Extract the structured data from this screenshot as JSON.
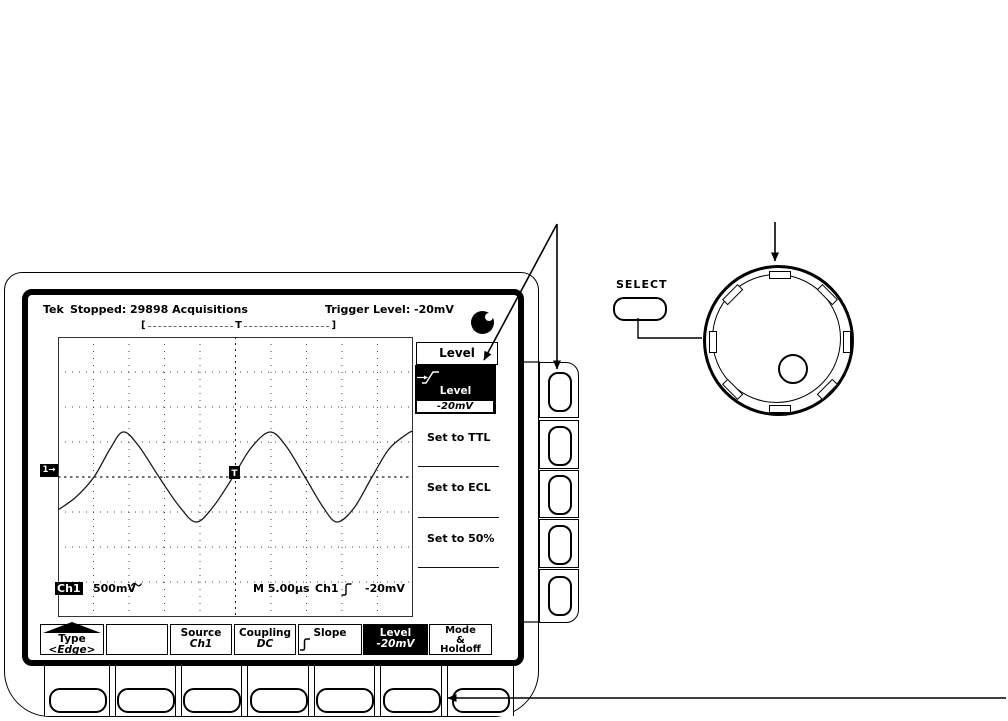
{
  "colors": {
    "ink": "#000000",
    "paper": "#ffffff"
  },
  "status_bar": {
    "logo": "Tek",
    "state": "Stopped:",
    "acquisitions": "29898 Acquisitions",
    "trigger_readout": "Trigger Level: -20mV"
  },
  "acq_bracket": {
    "left": "[",
    "center": "T",
    "right": "]"
  },
  "display": {
    "channel_marker": "1→",
    "trigger_marker": "T",
    "readout": {
      "channel": "Ch1",
      "vertical_scale": "500mV",
      "timebase": "M 5.00µs",
      "trigger_source": "Ch1",
      "trigger_level": "-20mV"
    }
  },
  "side_menu": {
    "title": "Level",
    "selected": {
      "label": "Level",
      "value": "-20mV"
    },
    "items": [
      "Set to TTL",
      "Set to ECL",
      "Set to 50%"
    ]
  },
  "bottom_menu": [
    {
      "label": "Type",
      "value": "<Edge>"
    },
    {
      "label": "",
      "value": ""
    },
    {
      "label": "Source",
      "value": "Ch1"
    },
    {
      "label": "Coupling",
      "value": "DC"
    },
    {
      "label": "Slope",
      "value": ""
    },
    {
      "label": "Level",
      "value": "-20mV"
    },
    {
      "lines": [
        "Mode",
        "&",
        "Holdoff"
      ]
    }
  ],
  "front_panel": {
    "select_label": "SELECT"
  },
  "icons": {
    "acquisition_icon": "acquisition-activity-icon",
    "edge_icon": "rising-edge-icon",
    "coupling_icon": "sine-coupling-icon"
  },
  "waveform": {
    "stroke": "#1a1a1a",
    "points": [
      [
        0,
        173
      ],
      [
        18,
        160
      ],
      [
        36,
        140
      ],
      [
        52,
        112
      ],
      [
        65,
        95
      ],
      [
        80,
        108
      ],
      [
        101,
        140
      ],
      [
        121,
        169
      ],
      [
        138,
        185
      ],
      [
        155,
        170
      ],
      [
        175,
        140
      ],
      [
        193,
        111
      ],
      [
        212,
        95
      ],
      [
        228,
        109
      ],
      [
        247,
        140
      ],
      [
        265,
        170
      ],
      [
        279,
        185
      ],
      [
        296,
        171
      ],
      [
        314,
        140
      ],
      [
        331,
        112
      ],
      [
        349,
        97
      ],
      [
        355,
        94
      ]
    ]
  }
}
